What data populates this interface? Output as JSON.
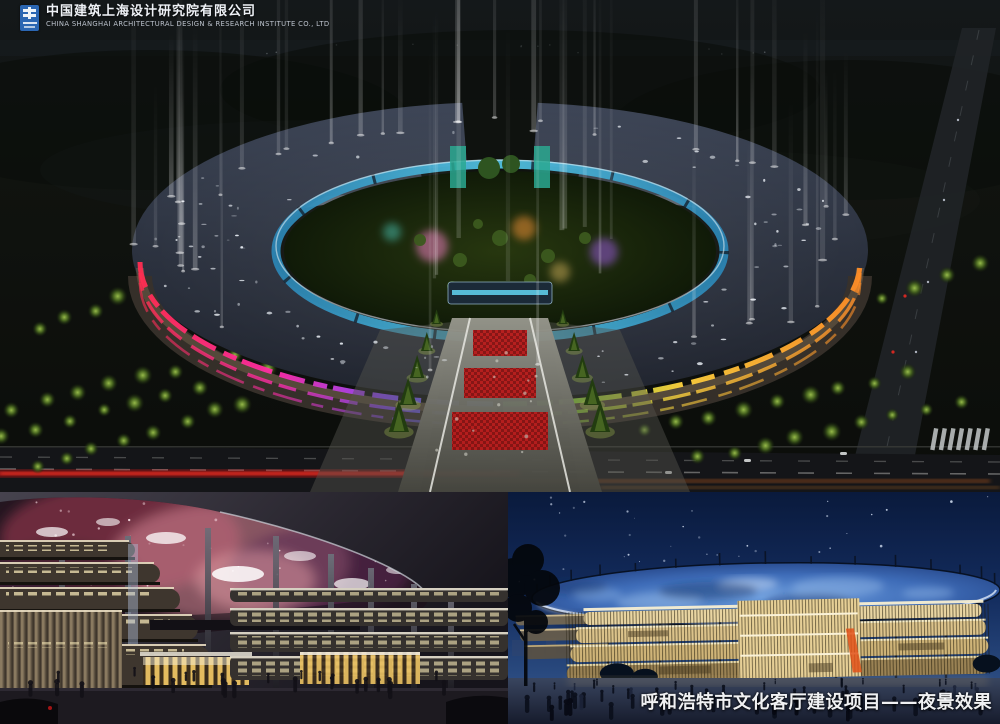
{
  "header": {
    "company_zh": "中国建筑上海设计研究院有限公司",
    "company_en": "CHINA SHANGHAI ARCHITECTURAL DESIGN & RESEARCH INSTITUTE CO., LTD",
    "logo_icon": "cscec-logo"
  },
  "caption": {
    "text": "呼和浩特市文化客厅建设项目——夜景效果"
  },
  "panels": {
    "aerial": {
      "label": "aerial-night-rendering"
    },
    "street_nebula": {
      "label": "street-rendering-nebula-canopy"
    },
    "street_blue": {
      "label": "street-rendering-blue-canopy"
    }
  },
  "colors": {
    "logo_blue": "#2b66b2",
    "facade_left": [
      "#ff2d50",
      "#ff2da8",
      "#8f4bff",
      "#3f8cff"
    ],
    "facade_right": [
      "#46d838",
      "#ffd23e",
      "#ff8c26"
    ],
    "ring_glass": "#45b8dc",
    "carpet_red": "#b81a1a",
    "nebula_pink": "#d98898",
    "canopy_blue": "#5e8fd6",
    "facade_gold": "#e9d5a2",
    "caption_white": "#f0f1f3"
  }
}
